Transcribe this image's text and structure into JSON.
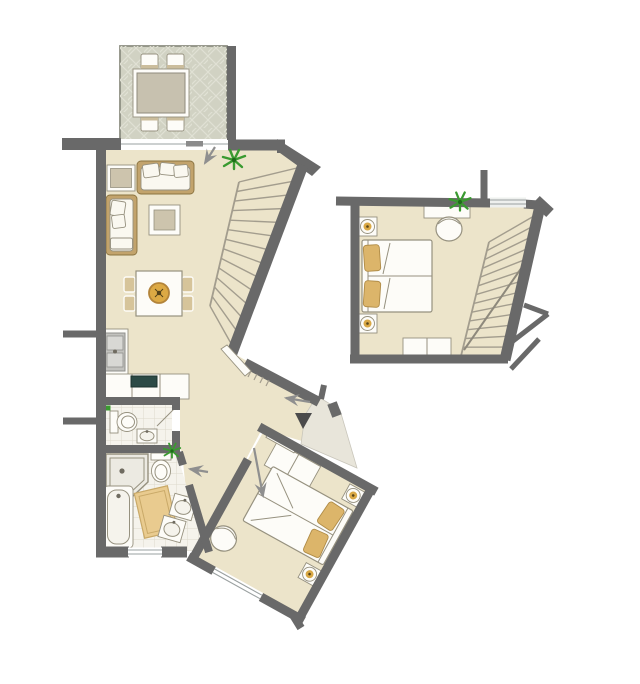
{
  "plan": {
    "title": "Apartment floor plan with terrace, open living room, kitchen, WC, bathroom and two bedrooms",
    "type": "architectural-floor-plan",
    "rooms": [
      {
        "id": "terrace",
        "name": "Terrace",
        "floor": "diamond-lattice paving",
        "furniture": [
          "outdoor dining table",
          "4 chairs"
        ]
      },
      {
        "id": "living-room",
        "name": "Living room",
        "floor": "cream",
        "furniture": [
          "sofa",
          "chaise longue",
          "side table",
          "coffee table",
          "dining table with 4 chairs and centerpiece",
          "staircase",
          "plant",
          "sliding door to terrace"
        ]
      },
      {
        "id": "kitchen",
        "name": "Kitchen",
        "floor": "cream",
        "furniture": [
          "L-shaped counter",
          "double sink",
          "dark cooktop"
        ]
      },
      {
        "id": "wc",
        "name": "Guest WC",
        "floor": "tiles",
        "furniture": [
          "toilet",
          "hand basin"
        ]
      },
      {
        "id": "bathroom",
        "name": "Bathroom",
        "floor": "tiles",
        "furniture": [
          "corner shower",
          "toilet",
          "bathtub",
          "two angled washbasins",
          "bath mat",
          "plant",
          "window"
        ]
      },
      {
        "id": "hall",
        "name": "Hall / entrance",
        "floor": "cream",
        "furniture": [
          "entrance door",
          "entrance triangle marker",
          "threshold steps",
          "landing"
        ]
      },
      {
        "id": "bedroom-upper",
        "name": "Bedroom (upper right)",
        "floor": "cream",
        "furniture": [
          "double bed",
          "2 nightstands with lamps",
          "desk",
          "chair",
          "dresser",
          "staircase",
          "plant",
          "window"
        ]
      },
      {
        "id": "bedroom-lower",
        "name": "Bedroom (lower, rotated)",
        "floor": "cream",
        "furniture": [
          "double bed",
          "2 nightstands with lamps",
          "wardrobe",
          "chair",
          "window"
        ]
      }
    ]
  },
  "colors": {
    "background": "#ffffff",
    "wall": "#696969",
    "wallDark": "#4b4b4b",
    "floor": "#ece4ca",
    "tile": "#f5f3ec",
    "tileLine": "#ddd9cc",
    "terrace": "#d1d2c3",
    "terraceLine": "#e0e1d4",
    "terraceBorder": "#8e8f83",
    "landing": "#e8e5da",
    "landingEdge": "#c9c6bb",
    "white": "#fdfcf8",
    "outline": "#96917f",
    "tan": "#c2a36c",
    "tanDark": "#8a7340",
    "wood": "#d6c49a",
    "beige": "#cdc4ad",
    "pillowWhite": "#faf8f0",
    "pillowTan": "#dcb56a",
    "pillowTanEdge": "#b08c47",
    "gold": "#dca944",
    "goldDark": "#b3843a",
    "goldDot": "#55431a",
    "green": "#3a9a30",
    "greenDark": "#1f6b1a",
    "stair": "#a39d8e",
    "arrow": "#8f8f8f",
    "windowGlass": "#eef0ee",
    "windowLine": "#9aa0a0",
    "stove": "#2c4a46",
    "stoveEdge": "#1d332f",
    "sinkGray": "#c2c2be",
    "sinkGrayIn": "#d8d8d4",
    "sinkGrayDark": "#8f8f8b",
    "mat": "#e9cb8f",
    "matEdge": "#c9a968",
    "shower": "#eceae2",
    "fixDot": "#6f6b60"
  }
}
